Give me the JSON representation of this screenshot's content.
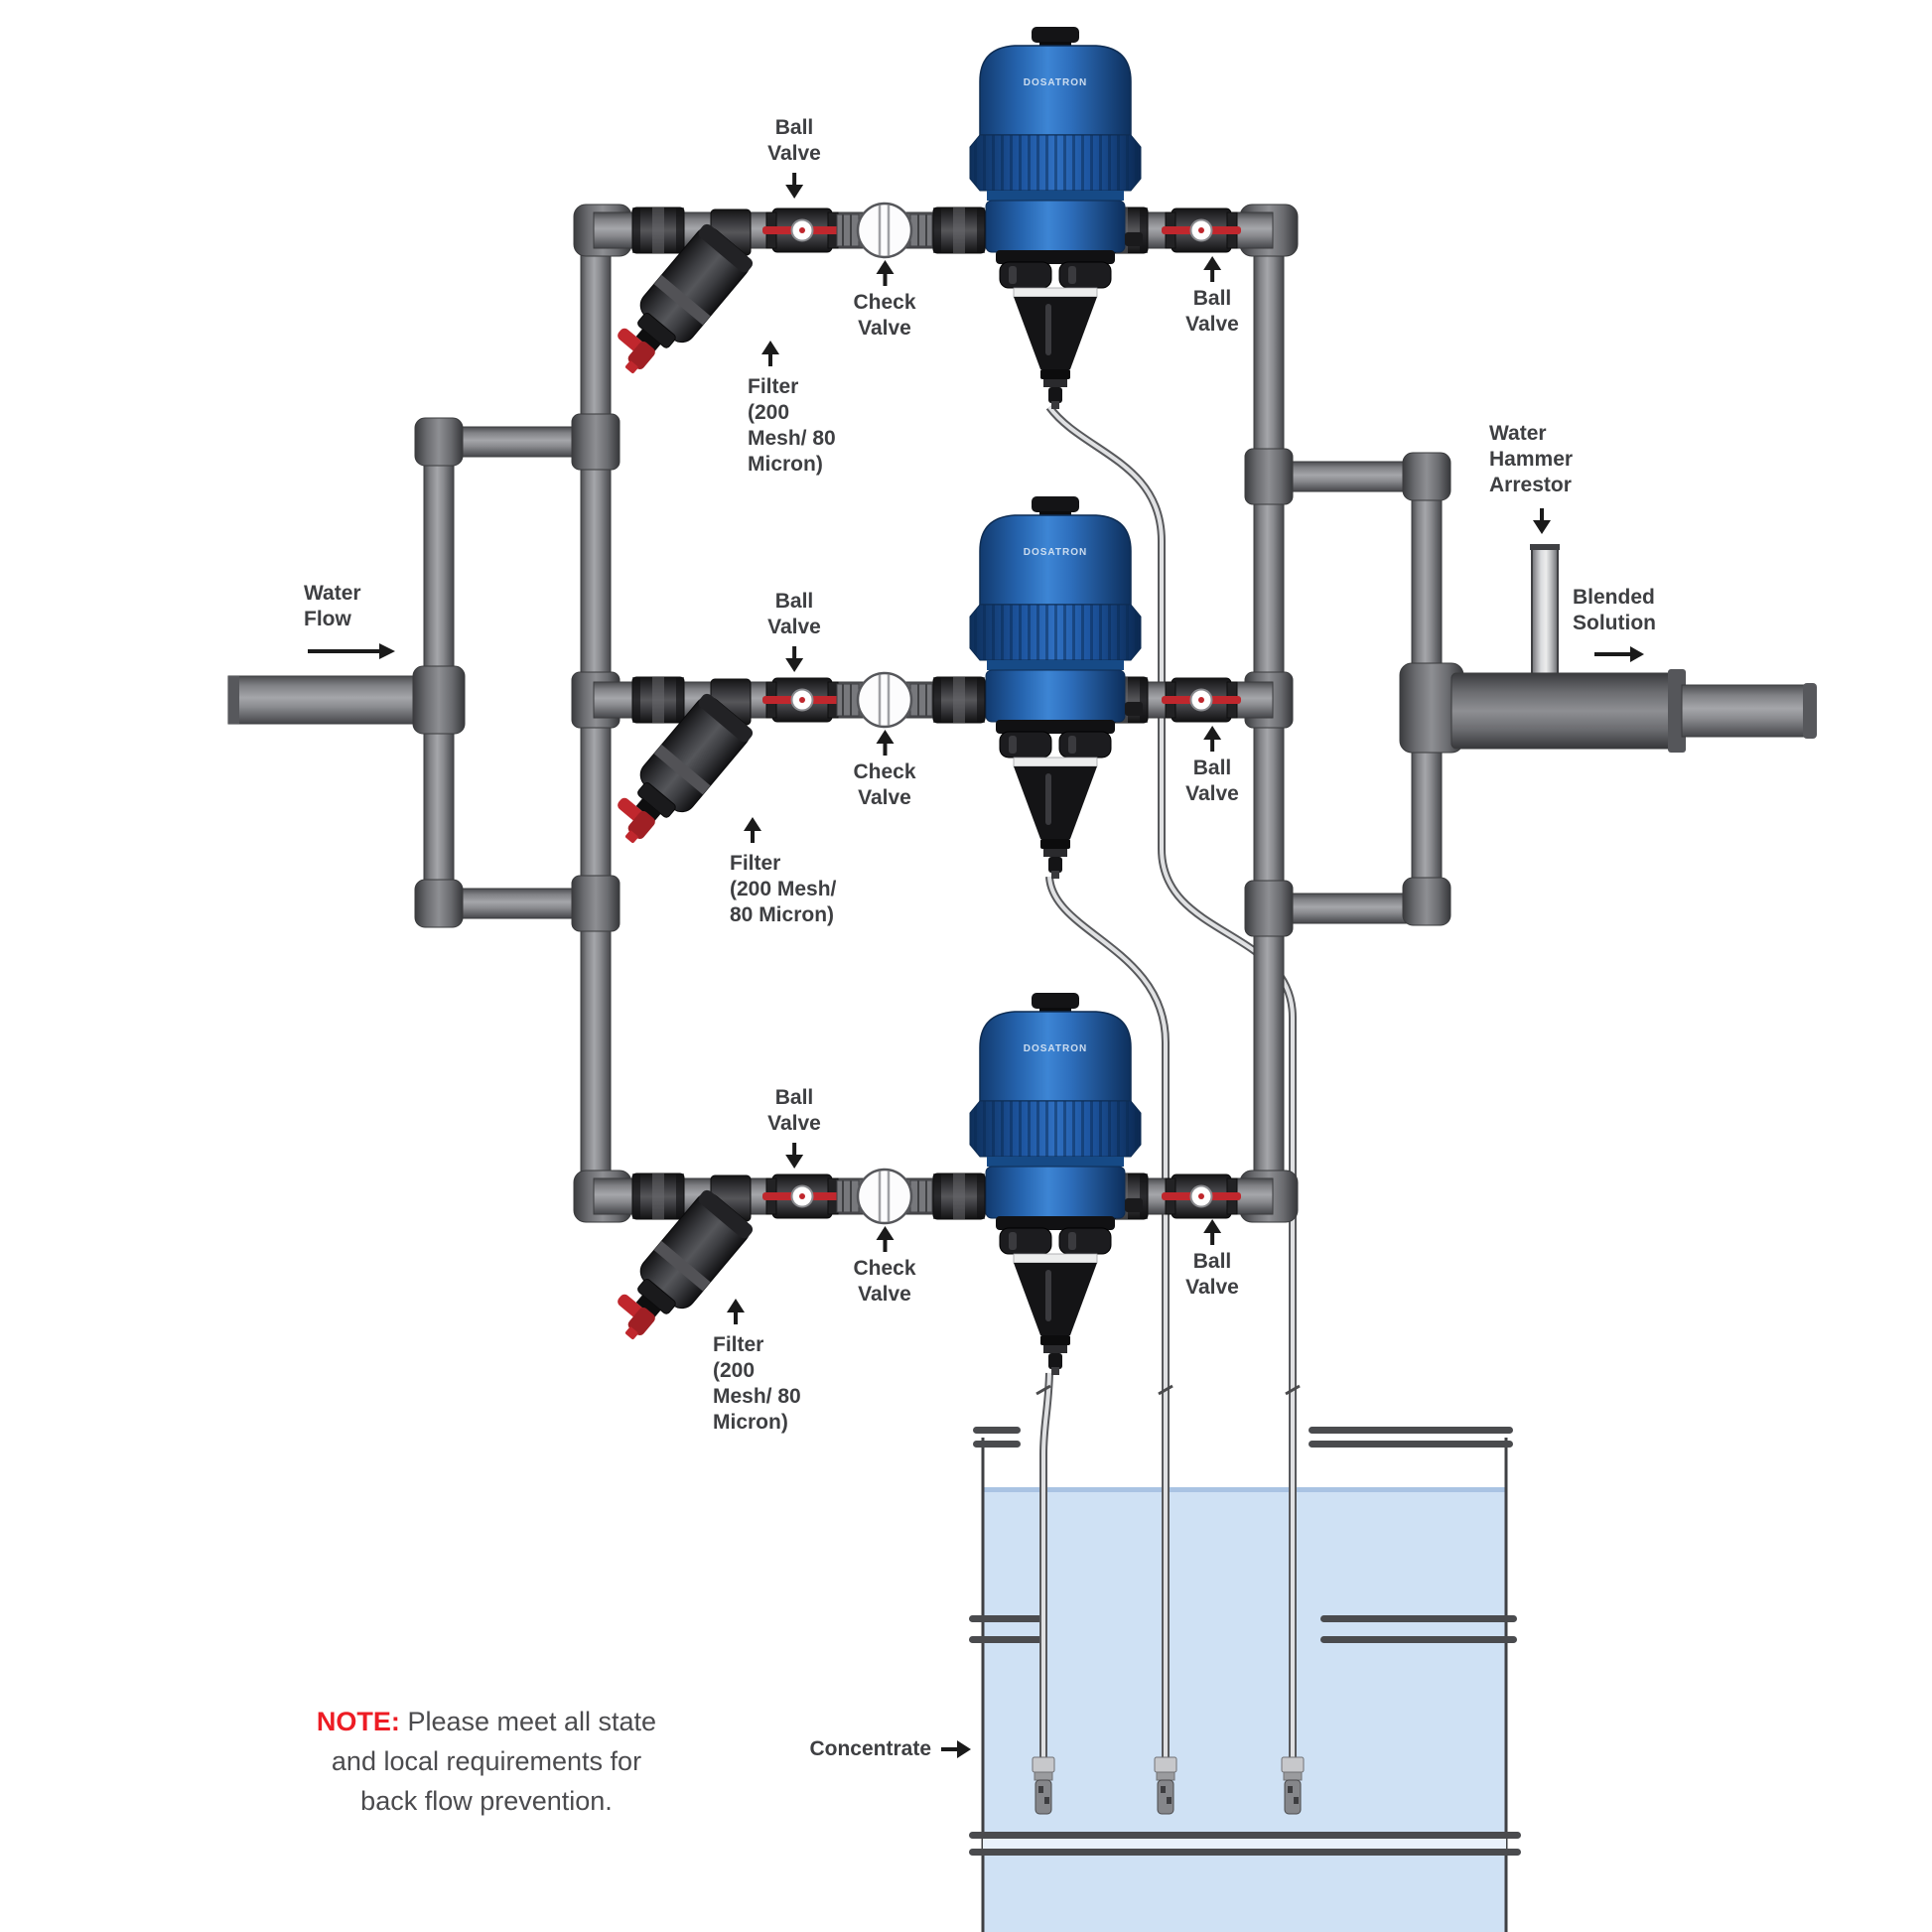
{
  "labels": {
    "water_flow": [
      "Water",
      "Flow"
    ],
    "ball_valve": [
      "Ball",
      "Valve"
    ],
    "check_valve": [
      "Check",
      "Valve"
    ],
    "filter_r1": [
      "Filter",
      "(200",
      "Mesh/ 80",
      "Micron)"
    ],
    "filter_r2": [
      "Filter",
      "(200 Mesh/",
      "80 Micron)"
    ],
    "filter_r3": [
      "Filter",
      "(200",
      "Mesh/ 80",
      "Micron)"
    ],
    "water_hammer_arrestor": [
      "Water",
      "Hammer",
      "Arrestor"
    ],
    "blended_solution": [
      "Blended",
      "Solution"
    ],
    "concentrate": "Concentrate",
    "pump_brand": "DOSATRON",
    "note": {
      "prefix": "NOTE:",
      "line1": "Please meet all state",
      "line2": "and local requirements for",
      "line3": "back flow prevention."
    }
  },
  "colors": {
    "pump_blue": "#2f6fc0",
    "pipe_gray": "#8a8b8f",
    "fitting_dark": "#2e2e31",
    "valve_red": "#c0272d",
    "liquid_blue": "#cfe1f4",
    "note_red": "#ed1c24",
    "label_text": "#3e3f42"
  }
}
